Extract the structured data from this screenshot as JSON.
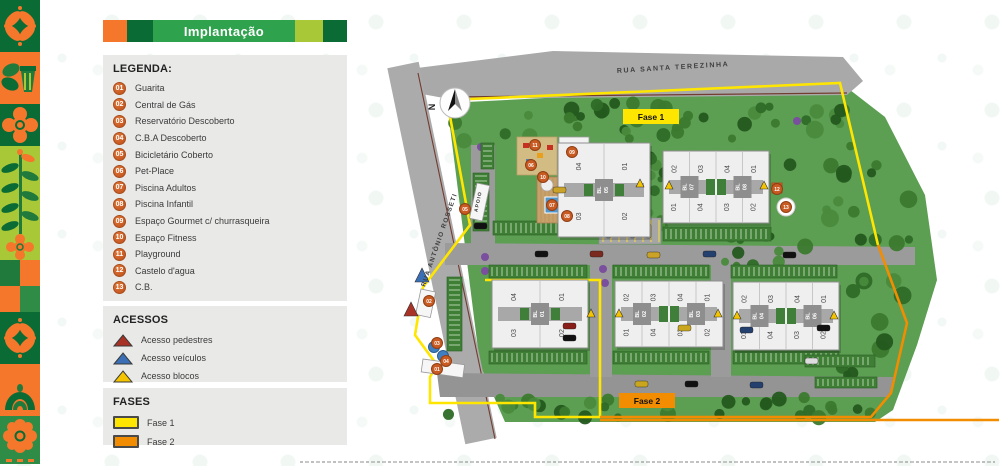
{
  "header": {
    "title": "Implantação"
  },
  "colors": {
    "orange": "#F4772B",
    "dark_green": "#0B6B35",
    "mid_green": "#2FA24D",
    "light_green": "#A9C837",
    "panel_bg": "#E9EAE8",
    "badge_orange": "#C85A22",
    "fase1_yellow": "#FFE600",
    "fase2_orange": "#F28C00",
    "acesso_pedestres": "#A93226",
    "acesso_veiculos": "#3B6FB5",
    "acesso_blocos": "#F5C400"
  },
  "legend": {
    "title": "LEGENDA:",
    "items": [
      {
        "num": "01",
        "label": "Guarita"
      },
      {
        "num": "02",
        "label": "Central de Gás"
      },
      {
        "num": "03",
        "label": "Reservatório Descoberto"
      },
      {
        "num": "04",
        "label": "C.B.A Descoberto"
      },
      {
        "num": "05",
        "label": "Bicicletário Coberto"
      },
      {
        "num": "06",
        "label": "Pet-Place"
      },
      {
        "num": "07",
        "label": "Piscina Adultos"
      },
      {
        "num": "08",
        "label": "Piscina Infantil"
      },
      {
        "num": "09",
        "label": "Espaço Gourmet c/ churrasqueira"
      },
      {
        "num": "10",
        "label": "Espaço Fitness"
      },
      {
        "num": "11",
        "label": "Playground"
      },
      {
        "num": "12",
        "label": "Castelo d'agua"
      },
      {
        "num": "13",
        "label": "C.B."
      }
    ]
  },
  "acessos": {
    "title": "ACESSOS",
    "items": [
      {
        "label": "Acesso pedestres",
        "color": "#A93226"
      },
      {
        "label": "Acesso veículos",
        "color": "#3B6FB5"
      },
      {
        "label": "Acesso blocos",
        "color": "#F5C400"
      }
    ]
  },
  "fases": {
    "title": "FASES",
    "items": [
      {
        "label": "Fase 1",
        "color": "#FFE600"
      },
      {
        "label": "Fase 2",
        "color": "#F28C00"
      }
    ]
  },
  "map": {
    "compass_label": "N",
    "street_top": "RUA SANTA TEREZINHA",
    "street_left": "RUA ANTÔNIO ROSSETI",
    "apoio_label": "APOIO",
    "fase1_label": "Fase 1",
    "fase2_label": "Fase 2",
    "blocks": [
      {
        "type": "single",
        "x": 173,
        "y": 118,
        "w": 92,
        "h": 94,
        "core": "BL 05",
        "units": [
          "04",
          "01",
          "03",
          "02"
        ]
      },
      {
        "type": "double",
        "x": 278,
        "y": 126,
        "w": 106,
        "h": 72,
        "cores": [
          "BL 07",
          "BL 08"
        ],
        "units_top": [
          "02",
          "03",
          "04",
          "01"
        ],
        "units_bottom": [
          "01",
          "04",
          "03",
          "02"
        ]
      },
      {
        "type": "single",
        "x": 107,
        "y": 255,
        "w": 96,
        "h": 68,
        "core": "BL 01",
        "units": [
          "04",
          "01",
          "03",
          "02"
        ]
      },
      {
        "type": "double",
        "x": 230,
        "y": 256,
        "w": 108,
        "h": 66,
        "cores": [
          "BL 02",
          "BL 03"
        ],
        "units_top": [
          "02",
          "03",
          "04",
          "01"
        ],
        "units_bottom": [
          "01",
          "04",
          "03",
          "02"
        ]
      },
      {
        "type": "double",
        "x": 348,
        "y": 257,
        "w": 106,
        "h": 68,
        "cores": [
          "BL 04",
          "BL 06"
        ],
        "units_top": [
          "02",
          "03",
          "04",
          "01"
        ],
        "units_bottom": [
          "01",
          "04",
          "03",
          "02"
        ]
      }
    ],
    "markers": [
      {
        "n": "01",
        "x": 52,
        "y": 344
      },
      {
        "n": "02",
        "x": 44,
        "y": 276
      },
      {
        "n": "03",
        "x": 52,
        "y": 318
      },
      {
        "n": "04",
        "x": 61,
        "y": 336
      },
      {
        "n": "05",
        "x": 80,
        "y": 184
      },
      {
        "n": "06",
        "x": 146,
        "y": 140
      },
      {
        "n": "07",
        "x": 167,
        "y": 180
      },
      {
        "n": "08",
        "x": 182,
        "y": 191
      },
      {
        "n": "09",
        "x": 187,
        "y": 127
      },
      {
        "n": "10",
        "x": 158,
        "y": 152
      },
      {
        "n": "11",
        "x": 150,
        "y": 120
      },
      {
        "n": "12",
        "x": 392,
        "y": 164
      },
      {
        "n": "13",
        "x": 401,
        "y": 182
      }
    ],
    "accesses": [
      {
        "type": "pedestres",
        "x": 26,
        "y": 284
      },
      {
        "type": "veiculos",
        "x": 37,
        "y": 250
      },
      {
        "type": "blocos",
        "x": 255,
        "y": 158
      },
      {
        "type": "blocos",
        "x": 284,
        "y": 160
      },
      {
        "type": "blocos",
        "x": 379,
        "y": 160
      },
      {
        "type": "blocos",
        "x": 206,
        "y": 288
      },
      {
        "type": "blocos",
        "x": 234,
        "y": 288
      },
      {
        "type": "blocos",
        "x": 333,
        "y": 288
      },
      {
        "type": "blocos",
        "x": 352,
        "y": 290
      },
      {
        "type": "blocos",
        "x": 449,
        "y": 290
      }
    ]
  }
}
